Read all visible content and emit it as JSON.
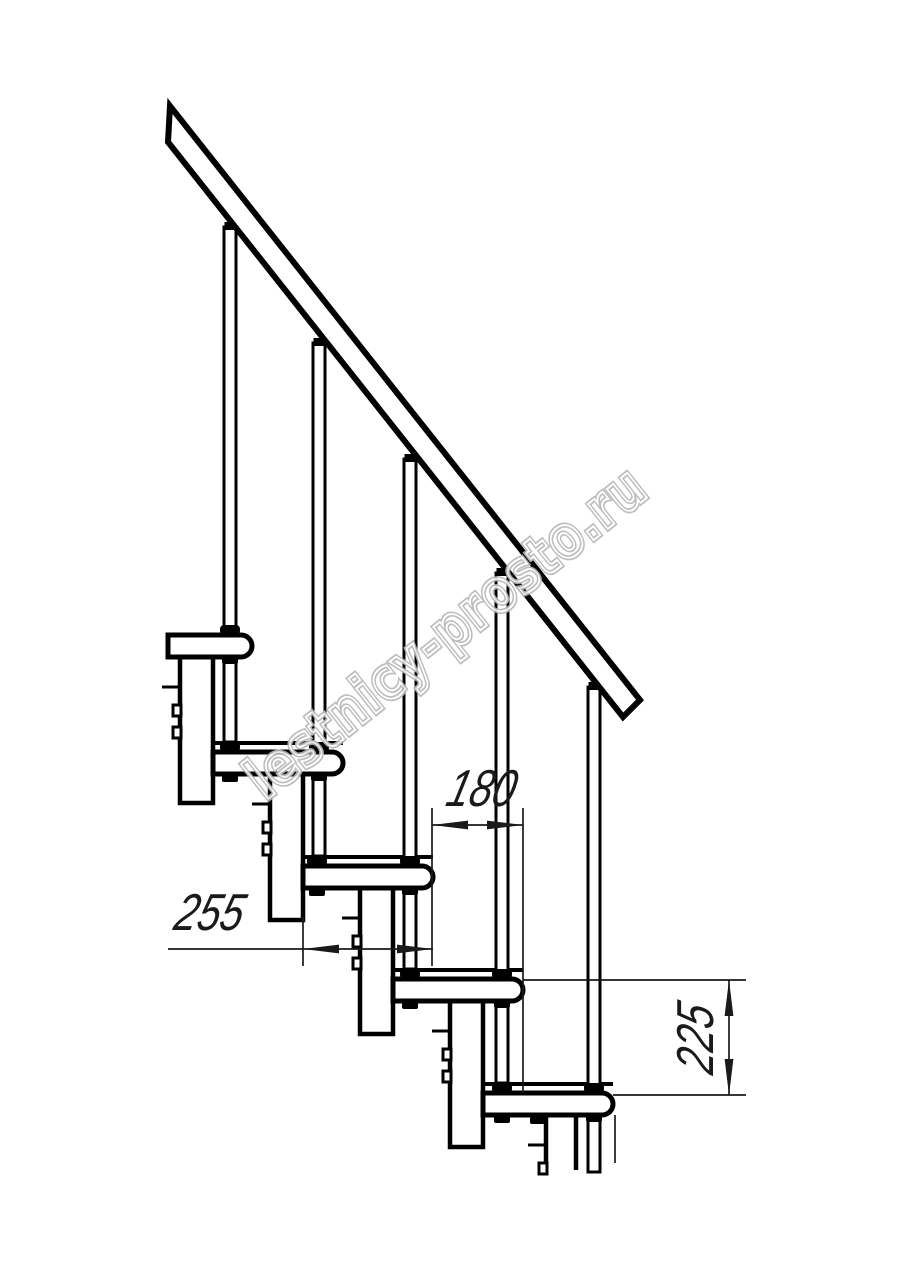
{
  "drawing": {
    "dimensions": [
      {
        "id": "dim-180",
        "label": "180",
        "orientation": "horizontal"
      },
      {
        "id": "dim-255",
        "label": "255",
        "orientation": "horizontal"
      },
      {
        "id": "dim-225",
        "label": "225",
        "orientation": "vertical"
      }
    ],
    "watermark": {
      "text": "lestnicy-prosto.ru"
    },
    "structure": {
      "treads_visible": 5,
      "balusters_visible": 5
    },
    "colors": {
      "line": "#000000",
      "dimension": "#1a1a1a",
      "watermark_outline": "#b6b6b6",
      "background": "#ffffff"
    }
  }
}
